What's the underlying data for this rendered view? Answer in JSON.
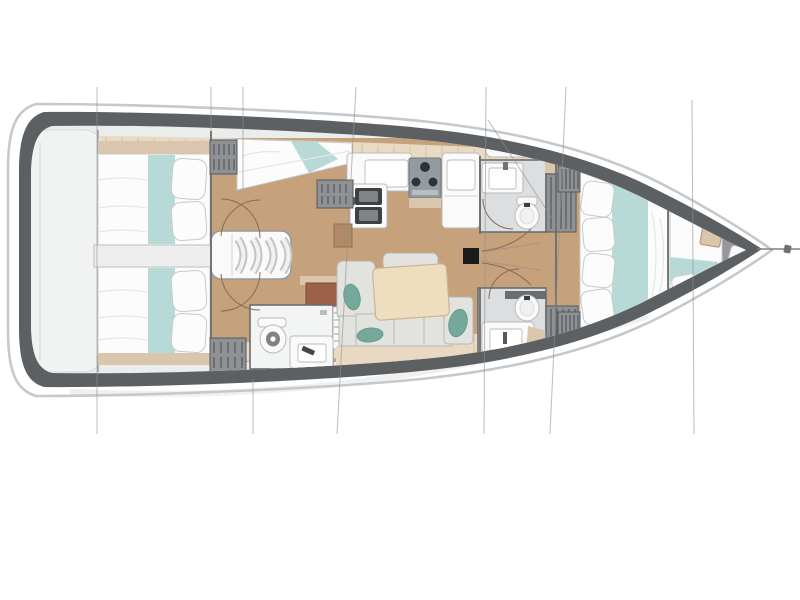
{
  "diagram": {
    "kind": "sailing-yacht-interior-floor-plan",
    "orientation": "bow-right",
    "regions": [
      "stern-swim-platform",
      "aft-cabin-port",
      "aft-cabin-starboard",
      "aft-corridor",
      "companionway-stairs",
      "aft-head",
      "nav-single-berth",
      "galley-sinks",
      "galley-stove",
      "galley-fridge-counter",
      "salon-sofa",
      "salon-table",
      "mast",
      "forward-head-port",
      "forward-head-starboard",
      "hanging-lockers",
      "forward-cabin-double-bed",
      "forepeak-berth",
      "bow-head-toilet",
      "rigging-section-lines",
      "bowsprit-line"
    ]
  },
  "colors": {
    "page_bg": "#ffffff",
    "hull_outline": "#c7c8ca",
    "hull_rim": "#5d6063",
    "deck": "#ebecec",
    "stern_platform": "#f1f2f2",
    "stern_platform_border": "#d7d8d9",
    "corridor": "#eeeeef",
    "corridor_border": "#bcbdbe",
    "wood": "#c5a17c",
    "plank": "#e8dac3",
    "plank_seam": "#cdbb9f",
    "bed": "#fcfcfc",
    "bed_stroke": "#c9c9c9",
    "bed_shade": "#e6e6e6",
    "teal": "#b7dad6",
    "teal_dark": "#74a89b",
    "teal_pillow_stroke": "#5f968b",
    "sofa": "#e2e3df",
    "sofa_stroke": "#b7b8b2",
    "table": "#eedebf",
    "table_stroke": "#ccb48f",
    "bench": "#ead9c2",
    "head_floor": "#dcdee0",
    "head_floor_light": "#f3f4f4",
    "wall": "#6a6d70",
    "fixture": "#fafafa",
    "fixture_stroke": "#b9babb",
    "sink_dark": "#3c4144",
    "sink_inner": "#7e8487",
    "stove": "#939ba0",
    "burner": "#2e3336",
    "locker": "#8f9294",
    "locker_line": "#54575a",
    "brown": "#9c6248",
    "brown_light": "#b08a66",
    "shelf": "#d9c6ad",
    "door_arc": "#8a6b50",
    "rig": "#8e8f91",
    "mast": "#1a1b1d",
    "shadow": "#e3e4e5"
  }
}
